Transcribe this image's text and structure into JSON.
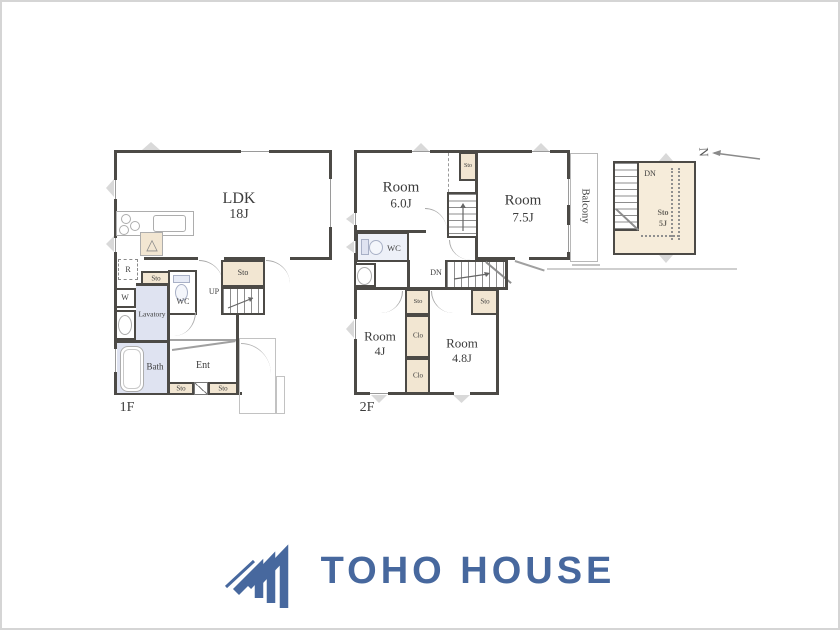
{
  "f1": {
    "floor": "1F",
    "ldk": "LDK",
    "ldk_size": "18J",
    "sto_hall": "Sto",
    "up": "UP",
    "r": "R",
    "sto_left": "Sto",
    "w": "W",
    "wc": "WC",
    "lavatory": "Lavatory",
    "bath": "Bath",
    "ent": "Ent",
    "sto_ent_left": "Sto",
    "sto_ent_right": "Sto"
  },
  "f2": {
    "floor": "2F",
    "room_nw": "Room",
    "room_nw_size": "6.0J",
    "sto_top": "Sto",
    "room_ne": "Room",
    "room_ne_size": "7.5J",
    "balcony": "Balcony",
    "wc": "WC",
    "dn": "DN",
    "sto_mid": "Sto",
    "clo_upper": "Clo",
    "clo_lower": "Clo",
    "room_sw": "Room",
    "room_sw_size": "4J",
    "room_se": "Room",
    "room_se_size": "4.8J",
    "sto_se": "Sto"
  },
  "attic": {
    "dn": "DN",
    "sto": "Sto",
    "sto_size": "5J"
  },
  "compass": {
    "letter": "N"
  },
  "logo": {
    "text": "TOHO HOUSE"
  },
  "colors": {
    "logo_blue": "#47689e",
    "wall": "#4c4a46",
    "closet_fill": "#f2e6d2",
    "wet_fill": "#dfe3f1"
  }
}
